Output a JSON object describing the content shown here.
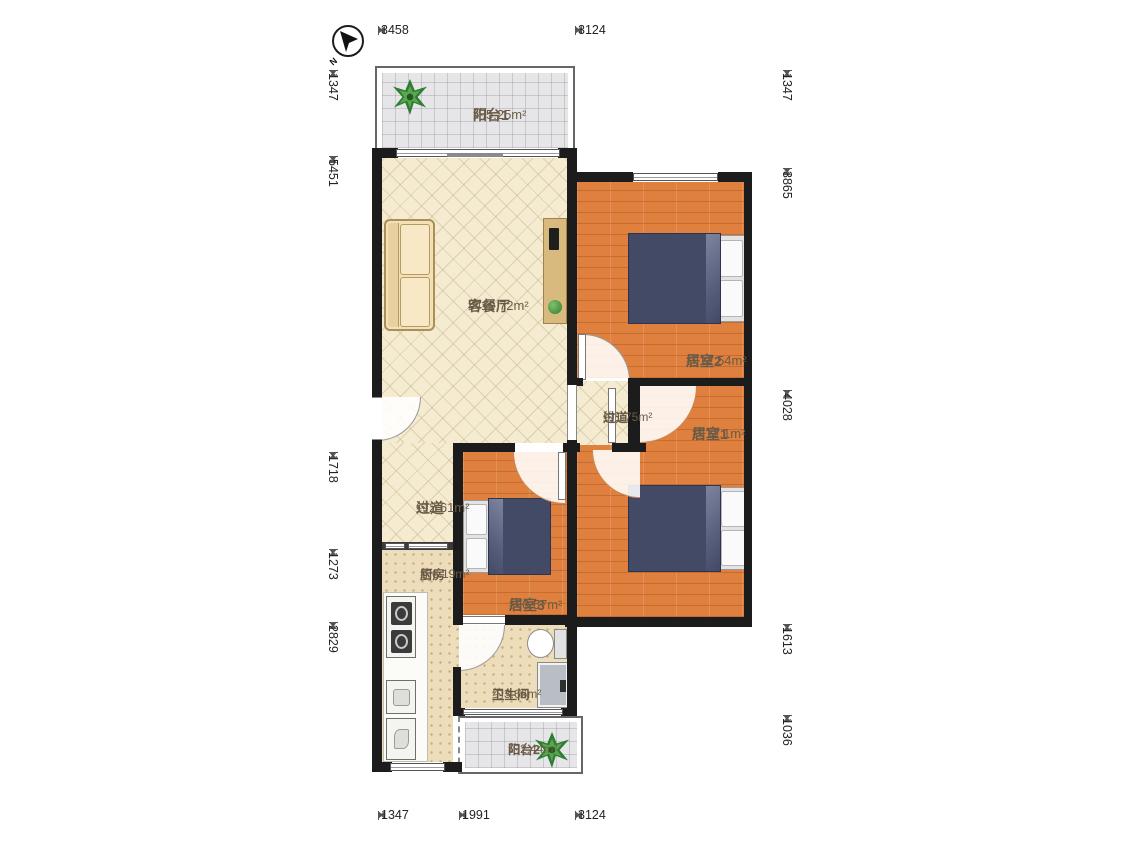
{
  "compass": {
    "label": "N"
  },
  "dimensions": {
    "top": [
      "3458",
      "3124"
    ],
    "bottom": [
      "1347",
      "1991",
      "3124"
    ],
    "left": [
      "1347",
      "5451",
      "1718",
      "1273",
      "2829"
    ],
    "right": [
      "1347",
      "3865",
      "4028",
      "1613",
      "1036"
    ]
  },
  "rooms": {
    "balcony1": {
      "name": "阳台1",
      "area": "约5.25m²"
    },
    "living": {
      "name": "客餐厅",
      "area": "约19.72m²"
    },
    "bedroom2": {
      "name": "居室2",
      "area": "约12.54m²"
    },
    "hallway1": {
      "name": "过道",
      "area": "约1.75m²"
    },
    "bedroom1": {
      "name": "居室1",
      "area": "约12.1m²"
    },
    "hallway2": {
      "name": "过道",
      "area": "约2.61m²"
    },
    "kitchen": {
      "name": "厨房",
      "area": "约6.19m²"
    },
    "bedroom3": {
      "name": "居室3",
      "area": "约6.57m²"
    },
    "bathroom": {
      "name": "卫生间",
      "area": "约3.66m²"
    },
    "balcony2": {
      "name": "阳台2",
      "area": "约2.44m²"
    }
  },
  "colors": {
    "wall": "#1c1c1c",
    "wood_floor": "#e0803e",
    "cream_floor": "#f4ebd1",
    "tile_floor": "#eeddbb",
    "balcony_floor": "#e6e6e8",
    "label_text": "#6a5b46",
    "dimension_text": "#222222"
  }
}
